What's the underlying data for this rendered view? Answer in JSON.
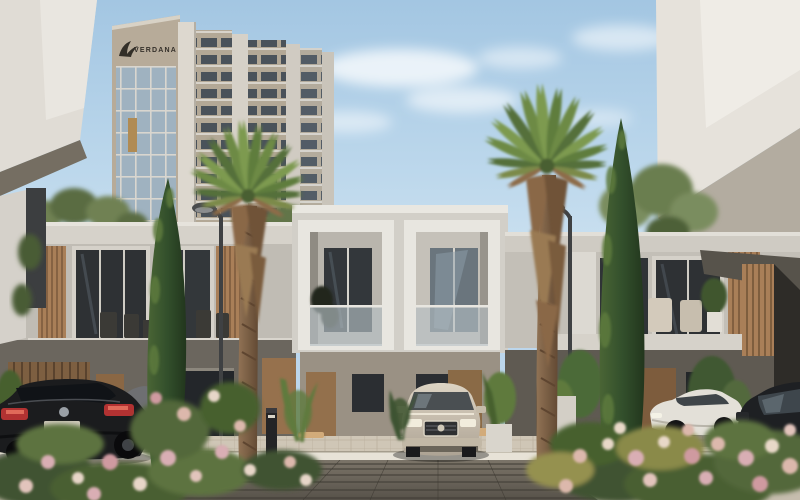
{
  "meta": {
    "type": "architectural-render",
    "description": "Exterior 3D render of a modern townhouse community courtyard with a high-rise tower behind, two fan palm trees, two cypress trees, parked cars, flowering landscaping and a central paver walkway under a soft blue sky."
  },
  "tower": {
    "logo_text": "VERDANA",
    "logo_icon": "falcon-icon"
  },
  "scene": {
    "objects": [
      "sky",
      "clouds",
      "background-tower",
      "foreground-building-left",
      "foreground-building-right",
      "townhouse-row-left",
      "townhouse-center",
      "townhouse-row-right",
      "palm-tree-left",
      "palm-tree-right",
      "cypress-tree-left",
      "cypress-tree-right",
      "street-lamp-left",
      "street-lamp-right",
      "bollard-light",
      "car-black-sedan",
      "car-champagne-suv",
      "car-white-sedan",
      "car-dark-suv",
      "paver-walkway",
      "parking-apron",
      "wheel-stops",
      "flower-bed-left",
      "flower-bed-right",
      "balcony-furniture",
      "potted-plants",
      "white-planter"
    ]
  },
  "palette": {
    "sky_top": "#a3c6e2",
    "sky_horizon": "#d7e7f3",
    "cloud": "#ffffff",
    "tower_stone": "#b7ab99",
    "tower_pier": "#ddd8cf",
    "tower_glass": "#9fb2c0",
    "corner_building_white": "#e3dfd8",
    "soffit_dark": "#756e62",
    "townhouse_white": "#d6d2ca",
    "box_frame_white": "#e9e7e1",
    "upper_wall": "#c0bcb4",
    "ground_floor": "#6b665e",
    "window_glass": "#2e3134",
    "wood_slat": "#a97f58",
    "wood_door": "#8a6744",
    "balustrade_glass": "#b6c0c4",
    "paver_light": "#cfc6b6",
    "paver_walkway": "#6e675d",
    "curb_white": "#e7e2d7",
    "palm_green": "#6d8a44",
    "palm_dry": "#8a6847",
    "cypress_green": "#33502c",
    "shrub_green": "#5d7340",
    "flower_pink": "#d9aeb4",
    "flower_cream": "#e7d6c8",
    "car_black": "#1b1c1e",
    "taillight_red": "#b23232",
    "car_champagne": "#d6cdbd",
    "car_white": "#e3e0d8",
    "lamp_grey": "#3f4143"
  }
}
